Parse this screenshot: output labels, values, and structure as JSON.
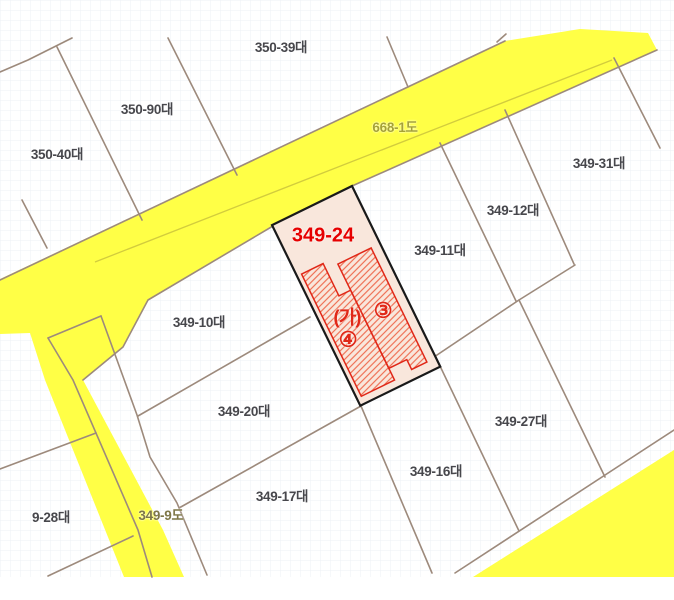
{
  "map": {
    "title": "cadastral-parcel-map",
    "highlighted_parcel": {
      "id": "349-24",
      "label": "349-24",
      "building_labels": [
        "(가)",
        "③",
        "④"
      ]
    },
    "labels": {
      "l350_39": {
        "text": "350-39대"
      },
      "l350_90": {
        "text": "350-90대"
      },
      "l350_40": {
        "text": "350-40대"
      },
      "r668_1": {
        "text": "668-1도"
      },
      "l349_31": {
        "text": "349-31대"
      },
      "l349_12": {
        "text": "349-12대"
      },
      "l349_11": {
        "text": "349-11대"
      },
      "l349_24": {
        "text": "349-24"
      },
      "l349_10": {
        "text": "349-10대"
      },
      "bldg_ga": {
        "text": "(가)"
      },
      "bldg_3": {
        "text": "③"
      },
      "bldg_4": {
        "text": "④"
      },
      "l349_20": {
        "text": "349-20대"
      },
      "l349_27": {
        "text": "349-27대"
      },
      "l349_16": {
        "text": "349-16대"
      },
      "l349_17": {
        "text": "349-17대"
      },
      "r349_9": {
        "text": "349-9도"
      },
      "l349_28": {
        "text": "9-28대"
      }
    },
    "theme": {
      "road_yellow": "#ffff46",
      "road_line_olive": "#d2cc3d",
      "parcel_line": "#9d8a7c",
      "highlight_fill": "#f9e7dc",
      "highlight_outline": "#1a1a1a",
      "building_red": "#e02818",
      "hatch_red": "#ee6a4e",
      "label_gray": "#47474c",
      "road_label_olive": "#a6a233",
      "road_label_dark": "#7e7747",
      "highlight_label_red": "#e60000",
      "grid_line": "#eef0f6"
    }
  }
}
